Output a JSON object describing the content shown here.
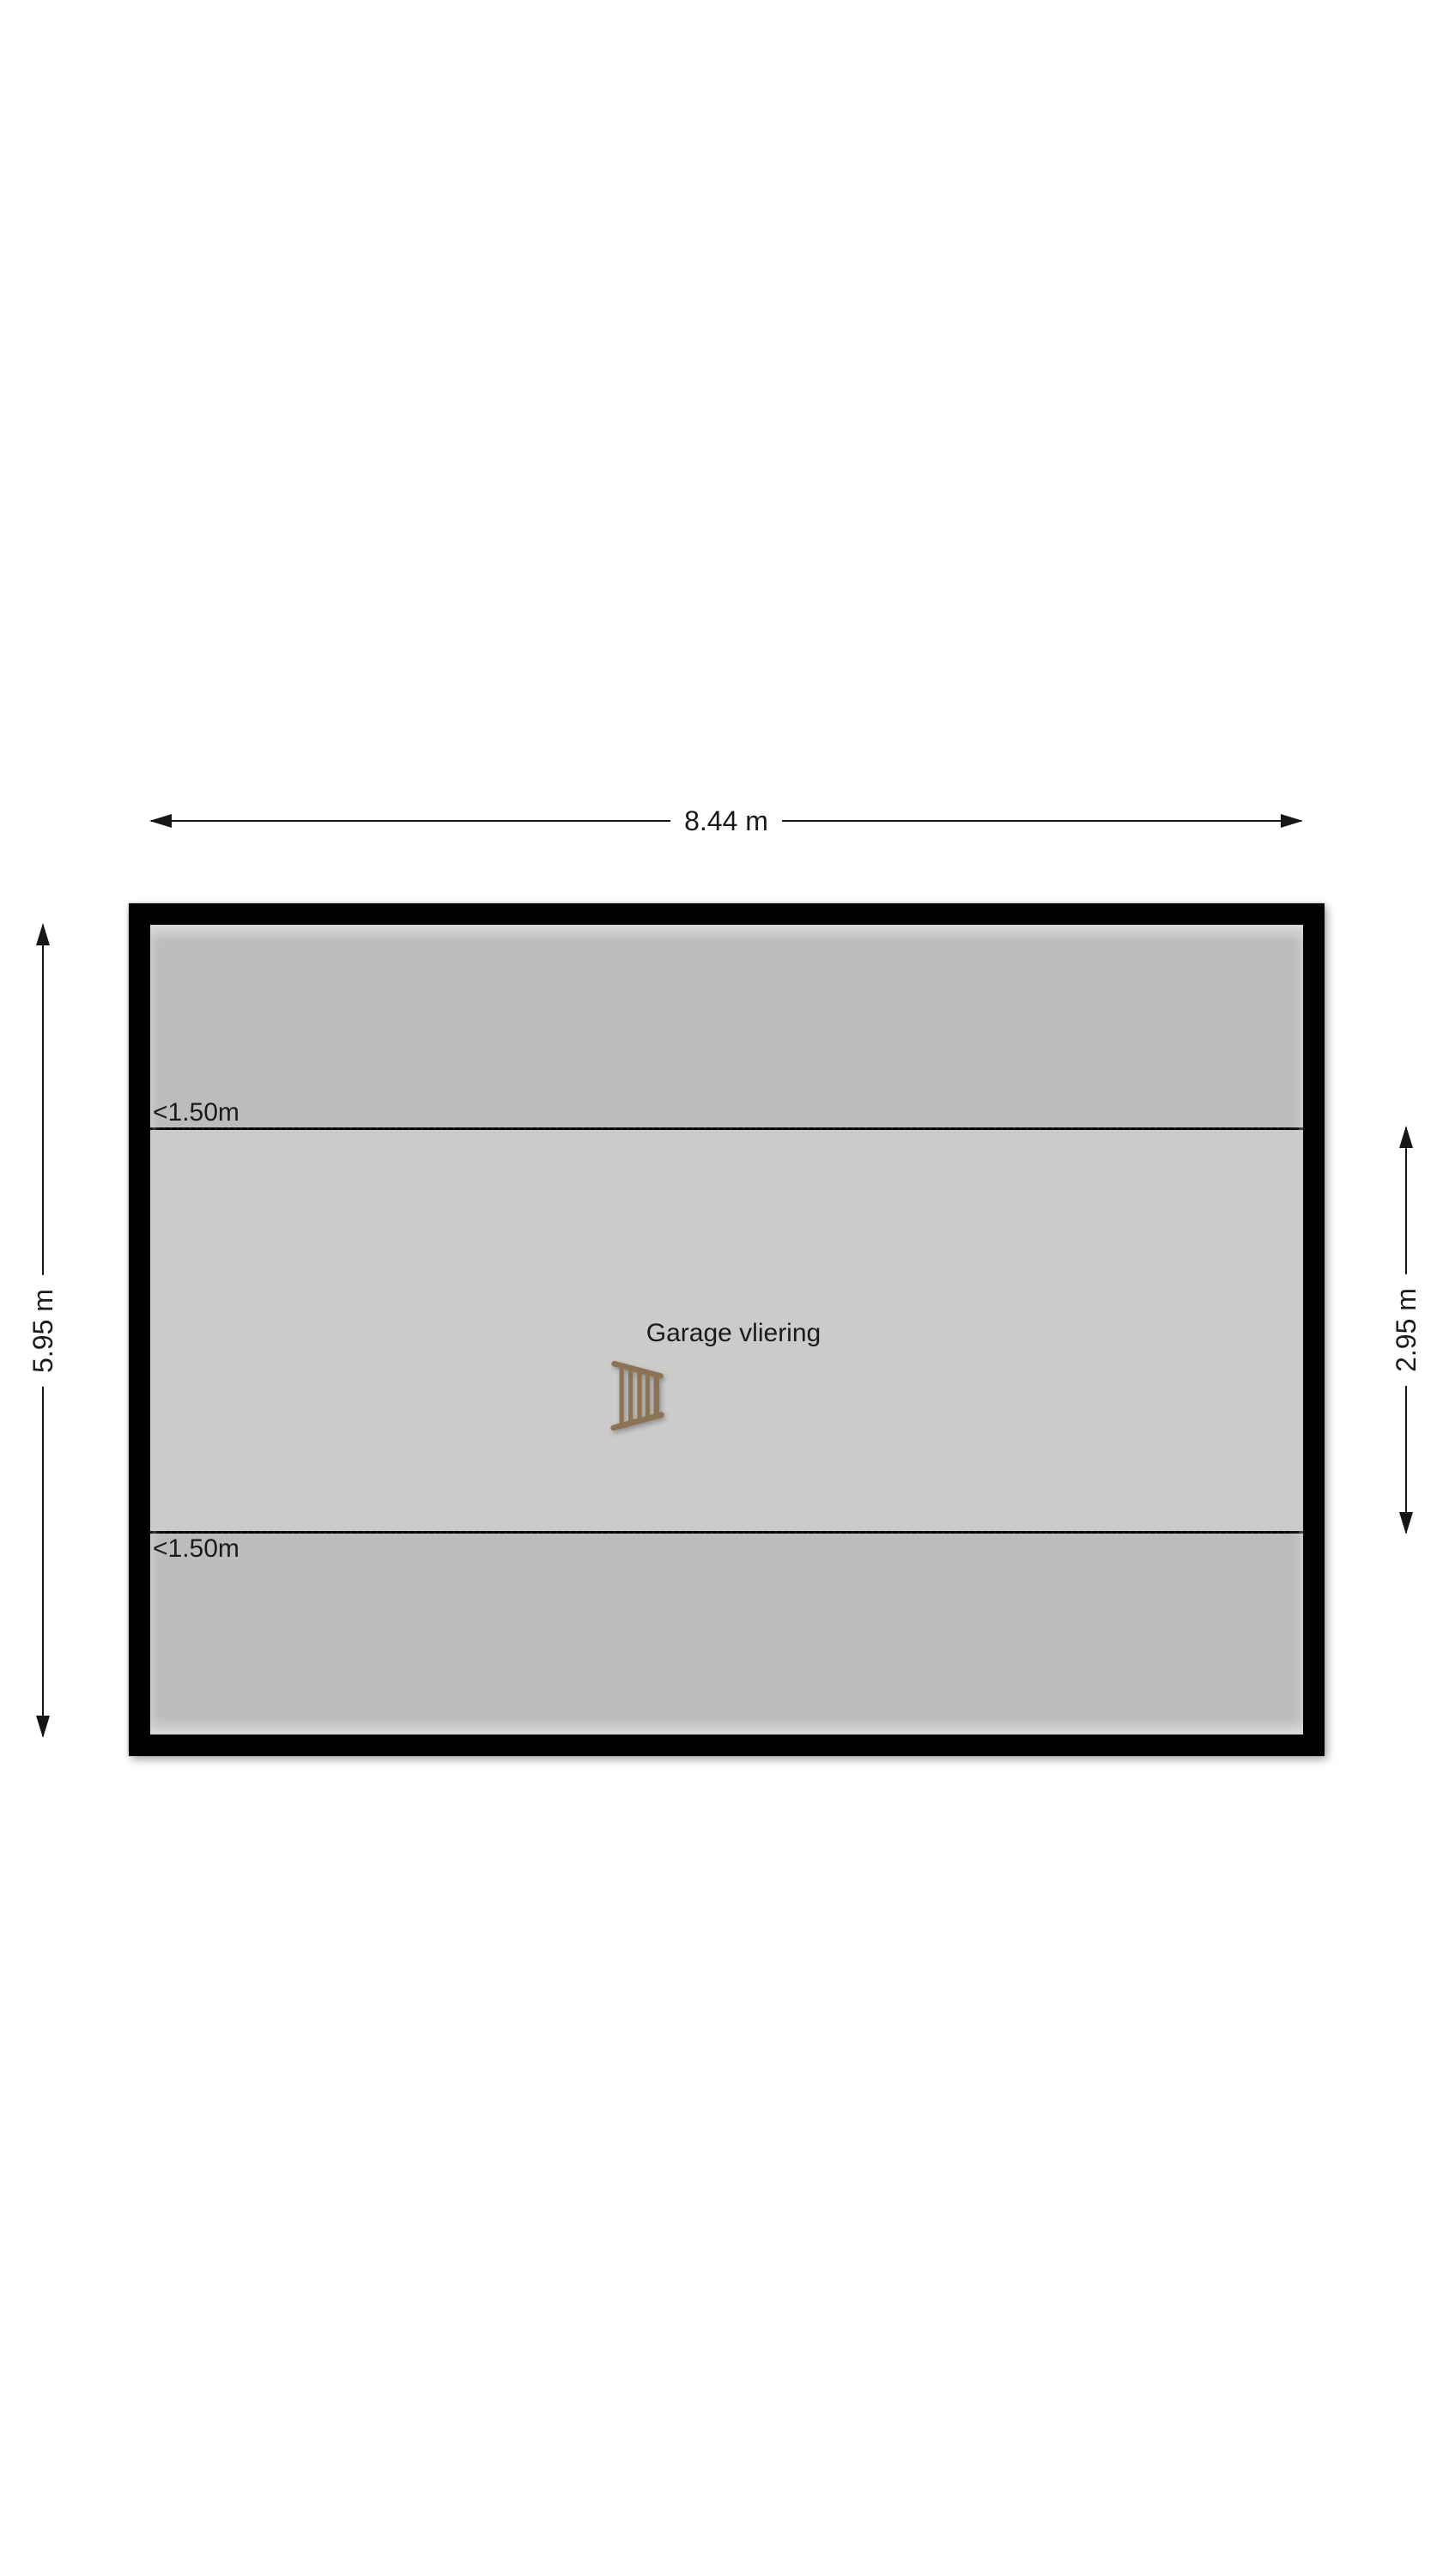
{
  "floorplan": {
    "room_label": "Garage vliering",
    "dimensions": {
      "width_label": "8.44 m",
      "height_label": "5.95 m",
      "inner_height_label": "2.95 m"
    },
    "clearance": {
      "top_label": "<1.50m",
      "bottom_label": "<1.50m"
    },
    "icons": {
      "ladder": "loft-ladder-icon"
    },
    "colors": {
      "background": "#ffffff",
      "wall": "#000000",
      "zone_low": "#bcbcba",
      "zone_main": "#cbcbc9",
      "text": "#1a1a1a",
      "ladder_wood": "#8c7356"
    }
  }
}
